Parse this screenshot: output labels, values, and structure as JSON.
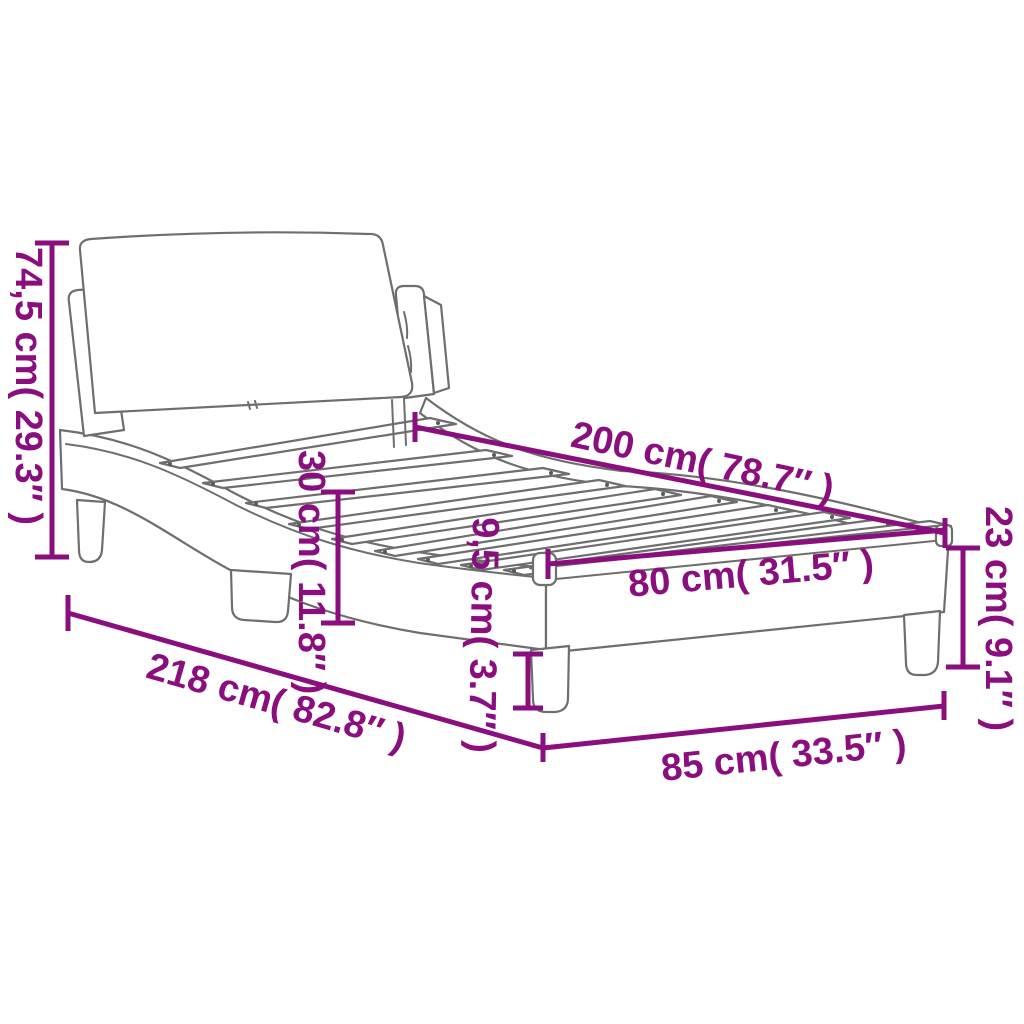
{
  "title": "Bed frame with headboard dimension diagram",
  "colors": {
    "accent": "#8B0E7E",
    "outline": "#6E6E6E",
    "background": "#FFFFFF"
  },
  "dimensions": {
    "headboard_height": "74,5 cm( 29.3″ )",
    "bed_length": "200 cm( 78.7″ )",
    "rail_height": "30 cm( 11.8″ )",
    "foot_end_height": "23 cm( 9.1″ )",
    "base_clearance": "9,5 cm( 3.7″ )",
    "slat_width": "80 cm( 31.5″ )",
    "total_length": "218 cm( 82.8″ )",
    "total_width": "85 cm( 33.5″ )"
  }
}
